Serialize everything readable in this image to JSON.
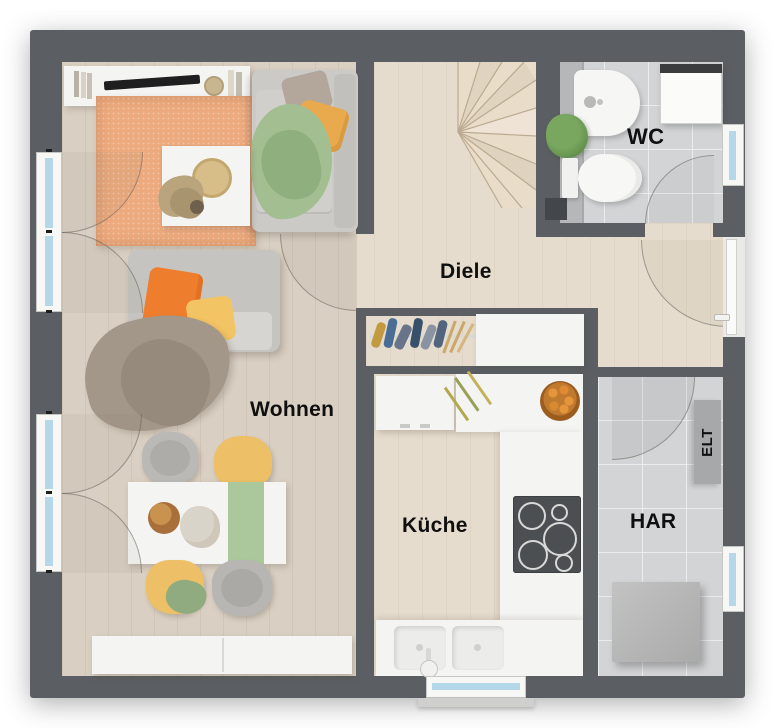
{
  "rooms": {
    "living": {
      "label": "Wohnen"
    },
    "kitchen": {
      "label": "Küche"
    },
    "hall": {
      "label": "Diele"
    },
    "wc": {
      "label": "WC"
    },
    "utility": {
      "label": "HAR"
    },
    "electrical": {
      "label": "ELT"
    }
  },
  "colors": {
    "wall": "#5b5f63",
    "wood_floor": "#d9cfc2",
    "hall_floor": "#e6dccd",
    "tile_floor": "#d3d4d6",
    "rug": "#ecaa7e",
    "accent_orange": "#ee7e2d",
    "accent_yellow": "#f3c464",
    "accent_green": "#a3bf92",
    "window_glass": "#b5d7ea",
    "furniture_white": "#f4f4f2"
  }
}
